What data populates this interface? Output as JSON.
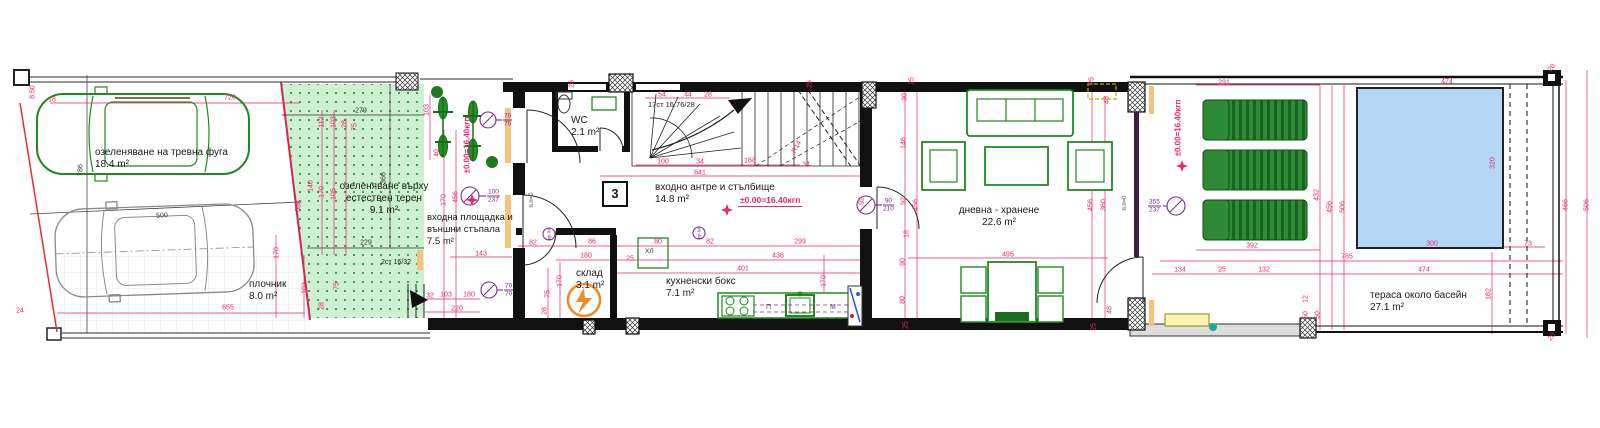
{
  "rooms": [
    {
      "id": "lawn-parking",
      "name": "озеленяване на тревна фуга",
      "area": "18.4 m²"
    },
    {
      "id": "natural-green",
      "name": "озеленяване върху естествен терен",
      "area": "9.1 m²"
    },
    {
      "id": "pavement",
      "name": "плочник",
      "area": "8.0 m²"
    },
    {
      "id": "entry-porch",
      "name": "входна площадка и външни стъпала",
      "area": "7.5 m²"
    },
    {
      "id": "wc",
      "name": "WC",
      "area": "2.1 m²"
    },
    {
      "id": "entry-hall",
      "name": "входно антре и стълбище",
      "area": "14.8 m²"
    },
    {
      "id": "storage",
      "name": "склад",
      "area": "3.1 m²"
    },
    {
      "id": "kitchenette",
      "name": "кухненски бокс",
      "area": "7.1 m²"
    },
    {
      "id": "living-dining",
      "name": "дневна - хранене",
      "area": "22.6 m²"
    },
    {
      "id": "pool-terrace",
      "name": "тераса около басейн",
      "area": "27.1 m²"
    }
  ],
  "annotations": {
    "unit_number": "3",
    "stair_main": "17ст 16.76/28",
    "stair_ext": "2ст 16/32",
    "level_main": "±0.00=16.40кгп",
    "level_entry": "±0.00=16.40кгп",
    "level_terrace": "±0.00=16.40кгп",
    "threshold": "п.п=0",
    "fridge": "ХЛ",
    "washer": "П",
    "dishwasher": "М"
  },
  "door_tags": [
    {
      "id": "entry-door",
      "w": "100",
      "h": "237"
    },
    {
      "id": "bike-rack",
      "w": "70",
      "h": "70"
    },
    {
      "id": "storage-door",
      "w": "70",
      "h": "70"
    },
    {
      "id": "living-door",
      "w": "90",
      "h": "210"
    },
    {
      "id": "terrace-window",
      "w": "355",
      "h": "237"
    },
    {
      "id": "frame-tag-1",
      "label": "вр-04"
    },
    {
      "id": "frame-tag-2",
      "label": "вр-04"
    }
  ],
  "colors": {
    "dimension": "#e9256d",
    "wall": "#111111",
    "furniture": "#1e8a1e",
    "pool": "#b5d7f6",
    "hatch": "#cdf0d0",
    "site": "#777777",
    "symbol": "#7b2c8f"
  },
  "dimensions": [
    {
      "t": "18",
      "x": 52,
      "y": 100
    },
    {
      "t": "8.50",
      "x": 33,
      "y": 92,
      "r": -90
    },
    {
      "t": "720",
      "x": 230,
      "y": 98
    },
    {
      "t": "786",
      "x": 81,
      "y": 170,
      "r": -90,
      "c": "d"
    },
    {
      "t": "500",
      "x": 162,
      "y": 216,
      "r": -3,
      "c": "d"
    },
    {
      "t": "24",
      "x": 20,
      "y": 311
    },
    {
      "t": "655",
      "x": 228,
      "y": 308
    },
    {
      "t": "586",
      "x": 299,
      "y": 206,
      "r": -80
    },
    {
      "t": "279",
      "x": 361,
      "y": 111,
      "c": "d"
    },
    {
      "t": "366",
      "x": 384,
      "y": 178,
      "r": -90,
      "c": "d"
    },
    {
      "t": "229",
      "x": 366,
      "y": 243,
      "c": "d"
    },
    {
      "t": "112",
      "x": 322,
      "y": 122,
      "r": -90
    },
    {
      "t": "103",
      "x": 334,
      "y": 122,
      "r": -90
    },
    {
      "t": "28",
      "x": 345,
      "y": 124,
      "r": -90
    },
    {
      "t": "75",
      "x": 355,
      "y": 127,
      "r": -90
    },
    {
      "t": "140",
      "x": 311,
      "y": 186,
      "r": -90
    },
    {
      "t": "170",
      "x": 322,
      "y": 192,
      "r": -90
    },
    {
      "t": "105",
      "x": 334,
      "y": 194,
      "r": -90
    },
    {
      "t": "170",
      "x": 277,
      "y": 253,
      "r": -90
    },
    {
      "t": "103",
      "x": 305,
      "y": 288,
      "r": -90
    },
    {
      "t": "75",
      "x": 337,
      "y": 286,
      "r": -90
    },
    {
      "t": "28",
      "x": 322,
      "y": 306,
      "r": -90
    },
    {
      "t": "103",
      "x": 427,
      "y": 110,
      "r": -90
    },
    {
      "t": "40",
      "x": 437,
      "y": 153,
      "r": -90
    },
    {
      "t": "170",
      "x": 444,
      "y": 200,
      "r": -90
    },
    {
      "t": "456",
      "x": 456,
      "y": 197,
      "r": -90
    },
    {
      "t": "32",
      "x": 430,
      "y": 296
    },
    {
      "t": "103",
      "x": 446,
      "y": 295
    },
    {
      "t": "180",
      "x": 469,
      "y": 295
    },
    {
      "t": "220",
      "x": 457,
      "y": 309
    },
    {
      "t": "143",
      "x": 481,
      "y": 254
    },
    {
      "t": "82",
      "x": 533,
      "y": 243
    },
    {
      "t": "86",
      "x": 592,
      "y": 242
    },
    {
      "t": "180",
      "x": 586,
      "y": 256
    },
    {
      "t": "25",
      "x": 630,
      "y": 259
    },
    {
      "t": "80",
      "x": 658,
      "y": 242
    },
    {
      "t": "82",
      "x": 710,
      "y": 242
    },
    {
      "t": "299",
      "x": 800,
      "y": 242
    },
    {
      "t": "436",
      "x": 778,
      "y": 256
    },
    {
      "t": "401",
      "x": 743,
      "y": 269
    },
    {
      "t": "170",
      "x": 824,
      "y": 281,
      "r": -90
    },
    {
      "t": "170",
      "x": 560,
      "y": 281,
      "r": -90
    },
    {
      "t": "75",
      "x": 548,
      "y": 294,
      "r": -90
    },
    {
      "t": "28",
      "x": 545,
      "y": 311,
      "r": -90
    },
    {
      "t": "54",
      "x": 662,
      "y": 95
    },
    {
      "t": "44",
      "x": 688,
      "y": 95
    },
    {
      "t": "28",
      "x": 708,
      "y": 95
    },
    {
      "t": "100",
      "x": 663,
      "y": 162
    },
    {
      "t": "34",
      "x": 700,
      "y": 162
    },
    {
      "t": "168",
      "x": 750,
      "y": 161
    },
    {
      "t": "34",
      "x": 806,
      "y": 165
    },
    {
      "t": "641",
      "x": 700,
      "y": 173
    },
    {
      "t": "R14",
      "x": 797,
      "y": 147,
      "r": -62
    },
    {
      "t": "25",
      "x": 572,
      "y": 84,
      "r": -90
    },
    {
      "t": "25",
      "x": 810,
      "y": 84,
      "r": -90
    },
    {
      "t": "25",
      "x": 912,
      "y": 81,
      "r": -90
    },
    {
      "t": "30",
      "x": 905,
      "y": 97,
      "r": -90
    },
    {
      "t": "146",
      "x": 904,
      "y": 143,
      "r": -90
    },
    {
      "t": "92",
      "x": 862,
      "y": 201,
      "r": -90
    },
    {
      "t": "92",
      "x": 904,
      "y": 201,
      "r": -90
    },
    {
      "t": "456",
      "x": 916,
      "y": 205,
      "r": -90
    },
    {
      "t": "18",
      "x": 907,
      "y": 234,
      "r": -90
    },
    {
      "t": "90",
      "x": 903,
      "y": 262,
      "r": -90
    },
    {
      "t": "80",
      "x": 903,
      "y": 300,
      "r": -90
    },
    {
      "t": "25",
      "x": 906,
      "y": 325,
      "r": -90
    },
    {
      "t": "495",
      "x": 1008,
      "y": 255
    },
    {
      "t": "25",
      "x": 1092,
      "y": 81,
      "r": -90
    },
    {
      "t": "48",
      "x": 1107,
      "y": 100,
      "r": -90
    },
    {
      "t": "456",
      "x": 1091,
      "y": 205,
      "r": -90
    },
    {
      "t": "360",
      "x": 1104,
      "y": 205,
      "r": -90
    },
    {
      "t": "48",
      "x": 1110,
      "y": 310,
      "r": -90
    },
    {
      "t": "25",
      "x": 1094,
      "y": 327,
      "r": -90
    },
    {
      "t": "291",
      "x": 1224,
      "y": 83
    },
    {
      "t": "392",
      "x": 1252,
      "y": 246
    },
    {
      "t": "134",
      "x": 1180,
      "y": 270
    },
    {
      "t": "25",
      "x": 1222,
      "y": 270
    },
    {
      "t": "132",
      "x": 1264,
      "y": 270
    },
    {
      "t": "785",
      "x": 1347,
      "y": 257
    },
    {
      "t": "474",
      "x": 1447,
      "y": 82
    },
    {
      "t": "320",
      "x": 1493,
      "y": 163,
      "r": -90
    },
    {
      "t": "300",
      "x": 1432,
      "y": 244
    },
    {
      "t": "73",
      "x": 1528,
      "y": 244
    },
    {
      "t": "474",
      "x": 1424,
      "y": 270
    },
    {
      "t": "162",
      "x": 1489,
      "y": 294,
      "r": -90
    },
    {
      "t": "432",
      "x": 1317,
      "y": 195,
      "r": -90
    },
    {
      "t": "456",
      "x": 1330,
      "y": 207,
      "r": -90
    },
    {
      "t": "506",
      "x": 1343,
      "y": 207,
      "r": -90
    },
    {
      "t": "466",
      "x": 1566,
      "y": 205,
      "r": -90
    },
    {
      "t": "506",
      "x": 1587,
      "y": 205,
      "r": -90
    },
    {
      "t": "20",
      "x": 1552,
      "y": 68,
      "r": -50
    },
    {
      "t": "20",
      "x": 1552,
      "y": 337,
      "r": -50
    },
    {
      "t": "12",
      "x": 1306,
      "y": 299,
      "r": -90
    },
    {
      "t": "50",
      "x": 1306,
      "y": 315,
      "r": -90
    },
    {
      "t": "50",
      "x": 1318,
      "y": 315,
      "r": -90
    }
  ]
}
